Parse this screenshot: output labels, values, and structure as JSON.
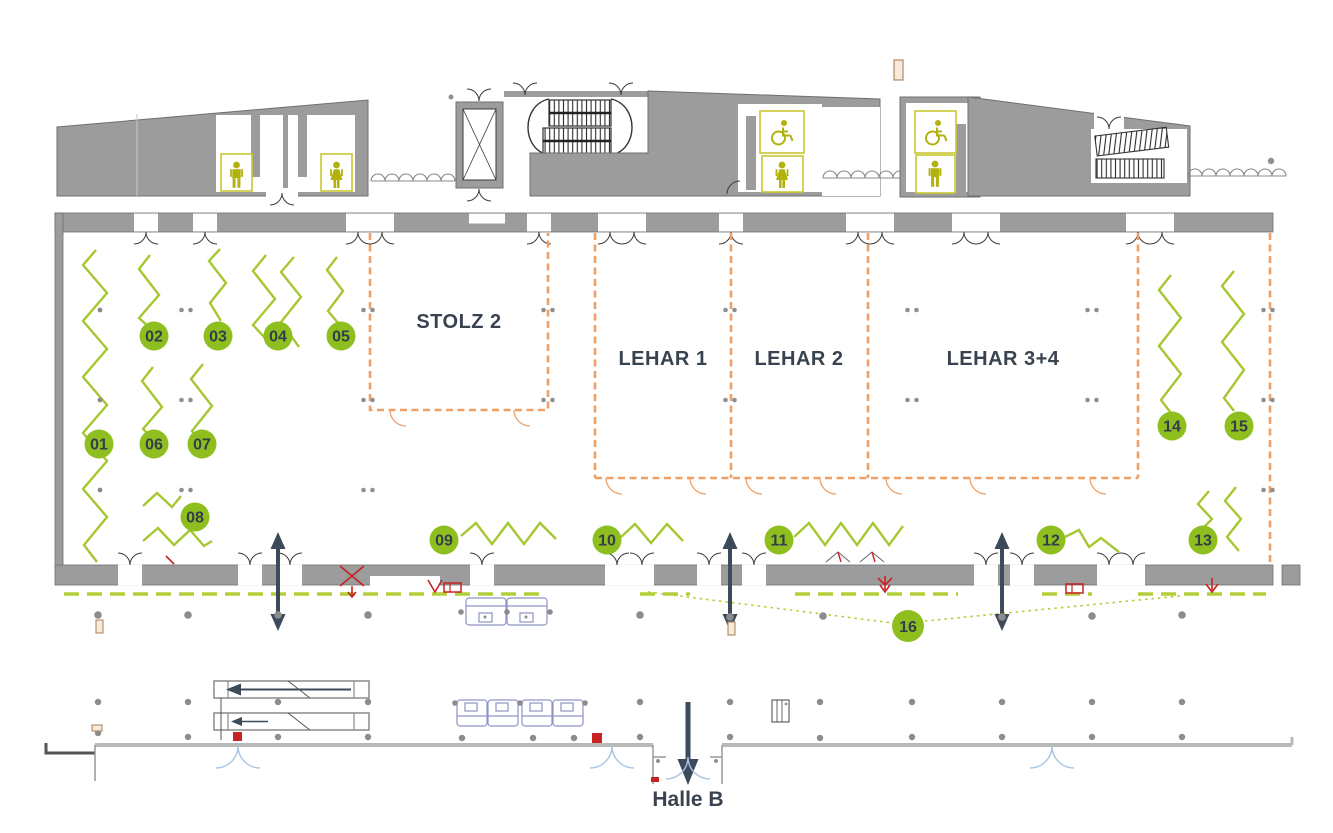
{
  "plan": {
    "rooms": {
      "stolz2": "STOLZ 2",
      "lehar1": "LEHAR 1",
      "lehar2": "LEHAR 2",
      "lehar34": "LEHAR 3+4"
    },
    "hall_b_label": "Halle B"
  },
  "markers": [
    "01",
    "02",
    "03",
    "04",
    "05",
    "06",
    "07",
    "08",
    "09",
    "10",
    "11",
    "12",
    "13",
    "14",
    "15",
    "16"
  ],
  "colors": {
    "marker_green": "#8fbf1f",
    "zigzag_green": "#a5c832",
    "dash_green": "#b2cf3a",
    "wall_gray": "#9c9c9c",
    "corridor_wall_gray": "#b9b9b9",
    "room_line_orange": "#efa066",
    "label_navy": "#39434f",
    "alert_red": "#c82222",
    "sanitary_olive": "#b2b20e",
    "door_blue": "#a9c6e4",
    "arrow_navy": "#3d4a5c"
  },
  "icons": {
    "wc_male": "male-pictogram",
    "wc_female": "female-pictogram",
    "wc_accessible": "wheelchair-pictogram",
    "elevator": "crossed-box",
    "stairs": "hatched-steps",
    "escalator": "walkway-with-arrow",
    "direction": "double-headed-arrow",
    "column": "gray-dot"
  }
}
